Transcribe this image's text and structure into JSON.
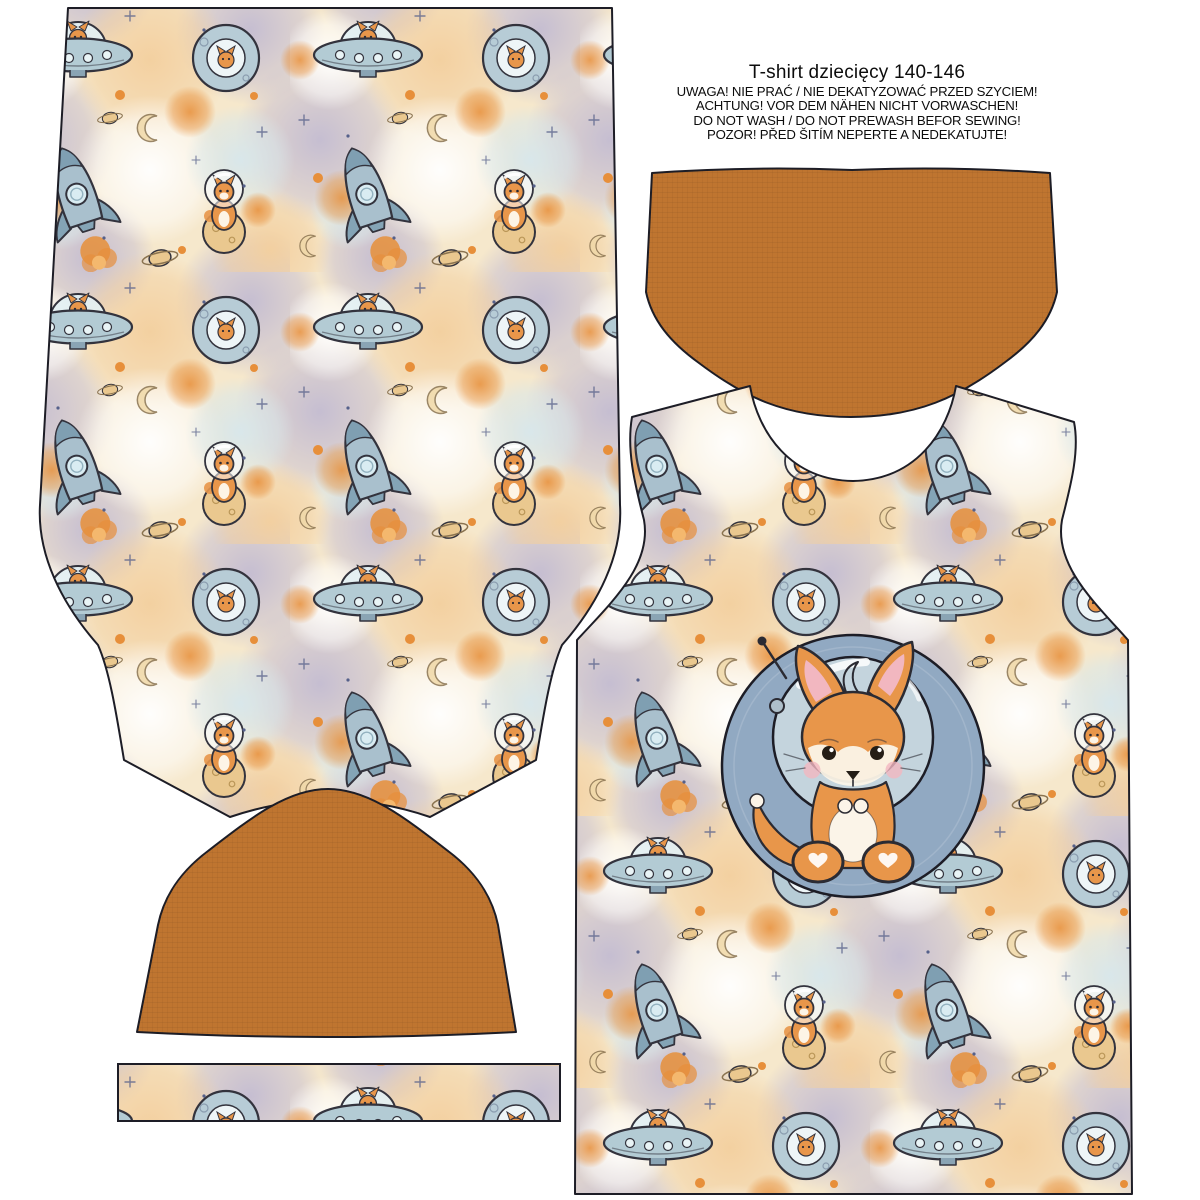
{
  "header": {
    "title": "T-shirt  dziecięcy 140-146",
    "warnings": [
      "UWAGA! NIE PRAĆ / NIE DEKATYZOWAĆ PRZED SZYCIEM!",
      "ACHTUNG! VOR DEM NÄHEN NICHT VORWASCHEN!",
      "DO NOT WASH / DO NOT PREWASH BEFOR SEWING!",
      "POZOR! PŘED ŠITÍM NEPERTE A NEDEKATUJTE!"
    ]
  },
  "colors": {
    "page_bg": "#ffffff",
    "outline": "#1d1d26",
    "sleeve": "#bf7530",
    "fabric_base": "#f6e8cc",
    "fabric_lavender": "#c0b9d2",
    "fabric_peach": "#f3cf9e",
    "fabric_blue": "#d7e7ec",
    "fabric_orange": "#e78f3a",
    "motif_steel": "#b3cbd4",
    "motif_rocket": "#a9c0cd",
    "motif_planet": "#eac88f",
    "fox_orange": "#e8964a",
    "badge_blue": "#91a9c2",
    "bubble_glass": "#c9d8e0",
    "blush_pink": "#f2b7c0"
  },
  "pieces": {
    "back_panel": "back panel",
    "front_panel": "front panel with fox badge",
    "sleeve_bottom": "sleeve",
    "sleeve_top": "sleeve",
    "neckband": "neckband strip"
  },
  "motifs": [
    "ufo-icon",
    "rocket-icon",
    "planet-icon",
    "fox-in-bubble-icon",
    "crescent-moon-icon",
    "saturn-icon",
    "sparkle-icon"
  ]
}
